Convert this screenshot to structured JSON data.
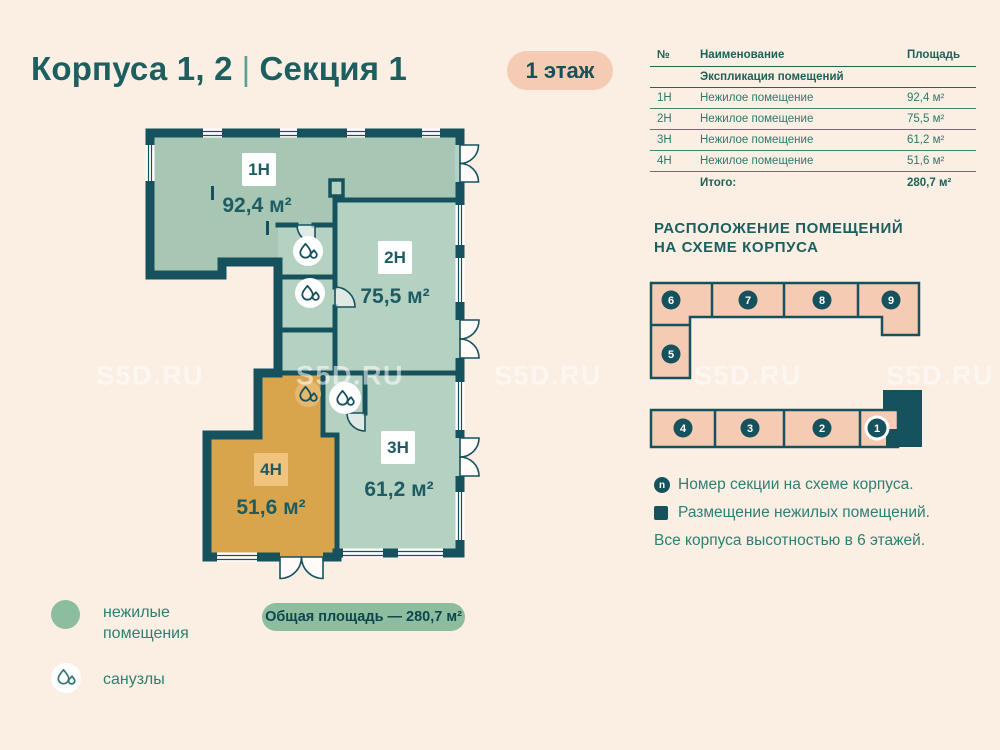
{
  "header": {
    "title": "Корпуса 1, 2",
    "divider": "|",
    "subtitle": "Секция 1",
    "floor_badge": "1 этаж"
  },
  "table": {
    "col_num": "№",
    "col_name": "Наименование",
    "col_area": "Площадь",
    "section_header": "Экспликация помещений",
    "rows": [
      {
        "num": "1Н",
        "name": "Нежилое помещение",
        "area": "92,4 м²"
      },
      {
        "num": "2Н",
        "name": "Нежилое помещение",
        "area": "75,5 м²"
      },
      {
        "num": "3Н",
        "name": "Нежилое помещение",
        "area": "61,2 м²"
      },
      {
        "num": "4Н",
        "name": "Нежилое помещение",
        "area": "51,6 м²"
      }
    ],
    "total_label": "Итого:",
    "total_area": "280,7 м²"
  },
  "plan": {
    "rooms": [
      {
        "label": "1Н",
        "area": "92,4 м²"
      },
      {
        "label": "2Н",
        "area": "75,5 м²"
      },
      {
        "label": "3Н",
        "area": "61,2 м²"
      },
      {
        "label": "4Н",
        "area": "51,6 м²",
        "highlighted": true
      }
    ]
  },
  "scheme": {
    "heading_line1": "РАСПОЛОЖЕНИЕ ПОМЕЩЕНИЙ",
    "heading_line2": "НА СХЕМЕ КОРПУСА",
    "sections": [
      "1",
      "2",
      "3",
      "4",
      "5",
      "6",
      "7",
      "8",
      "9"
    ],
    "badge_n": "n",
    "legend_section_number": "Номер секции на схеме корпуса.",
    "legend_nonresidential": "Размещение нежилых помещений.",
    "note": "Все корпуса высотностью в 6 этажей."
  },
  "legend": {
    "nonresidential_line1": "нежилые",
    "nonresidential_line2": "помещения",
    "bathrooms": "санузлы"
  },
  "total_badge": "Общая площадь — 280,7 м²",
  "watermark": "S5D.RU",
  "colors": {
    "background": "#fbeee3",
    "wall_teal": "#16525e",
    "room_green_dark": "#a7c7b4",
    "room_green_light": "#b5d1c2",
    "room_highlight_orange": "#d8a54c",
    "pink": "#f6cbb4",
    "sage": "#8cbd9e",
    "text_teal": "#2e7f74"
  }
}
